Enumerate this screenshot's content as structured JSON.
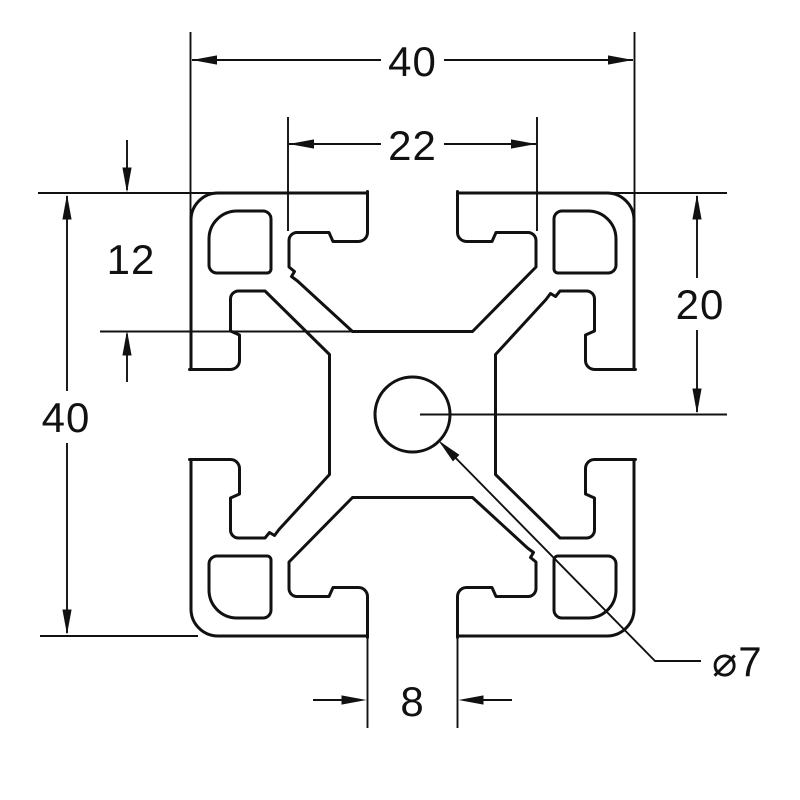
{
  "drawing": {
    "background_color": "#ffffff",
    "line_color": "#111111",
    "dimensions": {
      "overall_width": "40",
      "slot_inner_width": "22",
      "slot_depth": "12",
      "overall_height": "40",
      "face_to_center": "20",
      "slot_opening": "8",
      "center_hole_diameter": "⌀7"
    }
  }
}
